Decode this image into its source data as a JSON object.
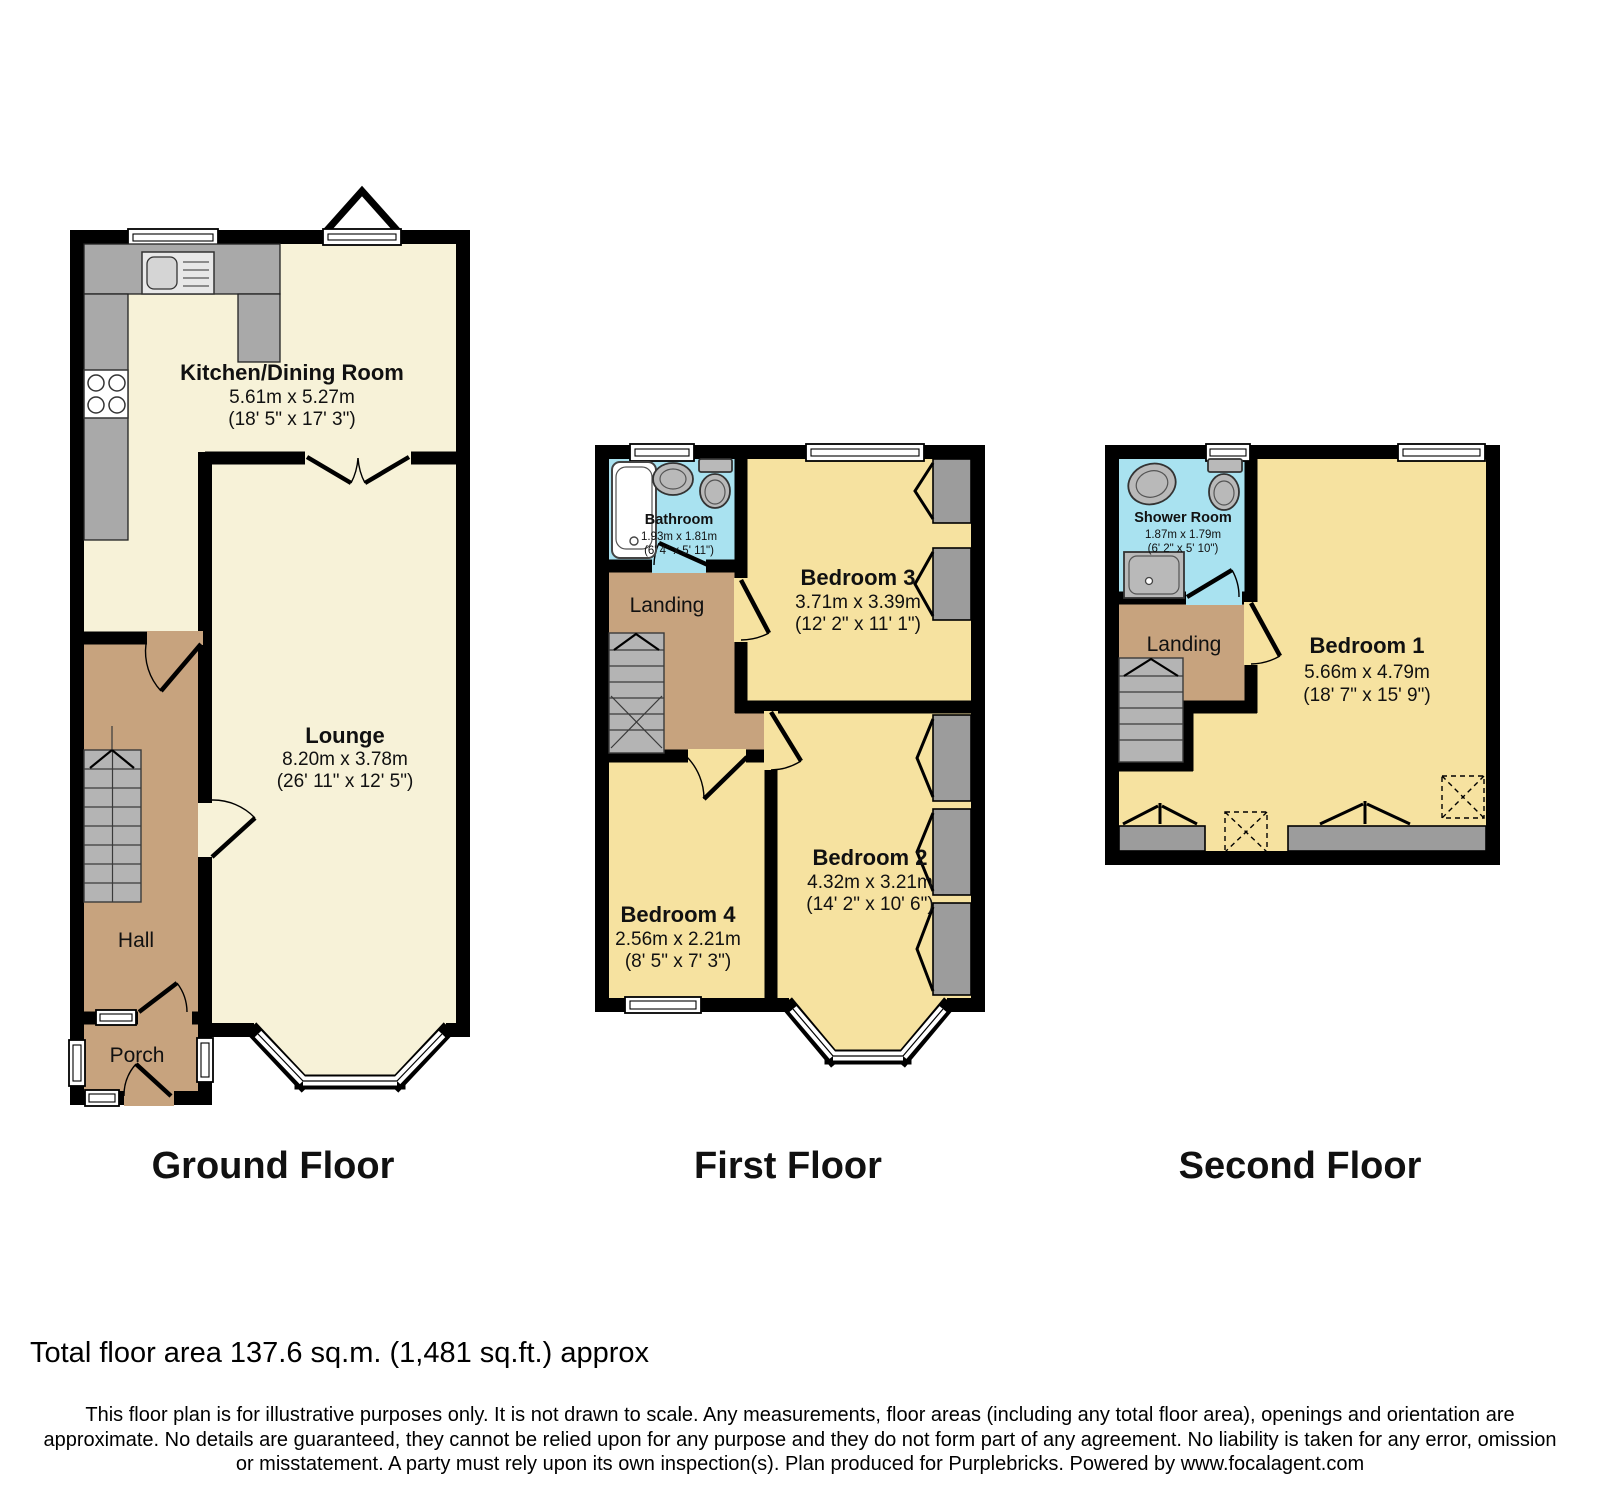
{
  "palette": {
    "wall": "#000000",
    "ground_floor_rooms": "#F7F2D8",
    "bedrooms": "#F6E2A0",
    "hall_landing": "#C7A37E",
    "bath_shower": "#A9E2F0",
    "counters_stairs": "#A9A9A9",
    "background": "#FFFFFF"
  },
  "floors": {
    "ground": {
      "title": "Ground Floor",
      "rooms": {
        "kitchen": {
          "name": "Kitchen/Dining Room",
          "metric": "5.61m x 5.27m",
          "imperial": "(18' 5\" x 17' 3\")"
        },
        "lounge": {
          "name": "Lounge",
          "metric": "8.20m x 3.78m",
          "imperial": "(26' 11\" x 12' 5\")"
        },
        "hall": {
          "name": "Hall"
        },
        "porch": {
          "name": "Porch"
        }
      }
    },
    "first": {
      "title": "First Floor",
      "rooms": {
        "bathroom": {
          "name": "Bathroom",
          "metric": "1.93m x 1.81m",
          "imperial": "(6' 4\" x 5' 11\")"
        },
        "bedroom3": {
          "name": "Bedroom 3",
          "metric": "3.71m x 3.39m",
          "imperial": "(12' 2\" x 11' 1\")"
        },
        "landing": {
          "name": "Landing"
        },
        "bedroom4": {
          "name": "Bedroom 4",
          "metric": "2.56m x 2.21m",
          "imperial": "(8' 5\" x 7' 3\")"
        },
        "bedroom2": {
          "name": "Bedroom 2",
          "metric": "4.32m x 3.21m",
          "imperial": "(14' 2\" x 10' 6\")"
        }
      }
    },
    "second": {
      "title": "Second Floor",
      "rooms": {
        "shower": {
          "name": "Shower Room",
          "metric": "1.87m x 1.79m",
          "imperial": "(6' 2\" x 5' 10\")"
        },
        "landing": {
          "name": "Landing"
        },
        "bedroom1": {
          "name": "Bedroom 1",
          "metric": "5.66m x 4.79m",
          "imperial": "(18' 7\" x 15' 9\")"
        }
      }
    }
  },
  "footer": {
    "total_area": "Total floor area 137.6 sq.m. (1,481 sq.ft.) approx",
    "disclaimer_lines": [
      "This floor plan is for illustrative purposes only. It is not drawn to scale. Any measurements, floor areas (including any total floor area), openings and orientation are",
      "approximate. No details are guaranteed, they cannot be relied upon for any purpose and they do not form part of any agreement. No liability is taken for any error, omission",
      "or misstatement. A party must rely upon its own inspection(s). Plan produced for Purplebricks. Powered by www.focalagent.com"
    ]
  }
}
